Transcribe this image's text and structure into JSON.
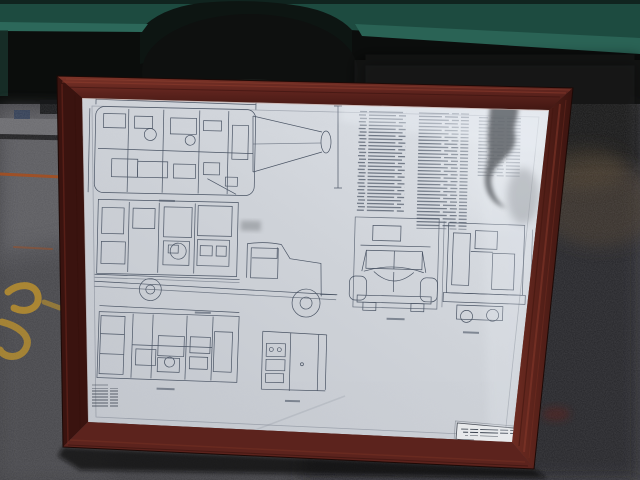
{
  "image_type": "photograph",
  "scene": {
    "subject": "framed technical blueprint leaning against a dark green vehicle on asphalt pavement",
    "frame_material": "dark reddish-brown wood frame with glass",
    "artwork": "multi-view vehicle engineering drawing of a truck with box body",
    "text_legible": false
  },
  "blueprint": {
    "drawings": [
      {
        "id": "plan-view-top",
        "position": "top-left"
      },
      {
        "id": "boom-detail",
        "position": "top-center"
      },
      {
        "id": "parts-list-columns",
        "position": "top-right",
        "columns": 3
      },
      {
        "id": "side-elevation-truck",
        "position": "middle-left"
      },
      {
        "id": "front-view-truck",
        "position": "middle-right"
      },
      {
        "id": "rear-view-truck",
        "position": "far-right"
      },
      {
        "id": "plan-view-bottom",
        "position": "bottom-left"
      },
      {
        "id": "compartment-detail",
        "position": "bottom-center"
      },
      {
        "id": "revision-stamp",
        "position": "bottom-left-corner"
      },
      {
        "id": "title-block",
        "position": "bottom-right",
        "text_lines": 4,
        "text_legible": false
      }
    ]
  },
  "colors": {
    "backdrop_black": "#0b0d0c",
    "vehicle_green": "#1d4b40",
    "vehicle_green_light": "#2c685a",
    "vehicle_green_light2": "#2a6355",
    "vehicle_green_dark": "#0d1512",
    "asphalt": "#3e3e42",
    "asphalt_light": "#5e5e63",
    "asphalt_dark": "#232327",
    "curb_gray": "#6a6a6e",
    "paint_yellow": "#c0942c",
    "paint_orange": "#a84e1c",
    "paint_red_smudge": "#6b1f18",
    "frame_wood": "#5c231d",
    "frame_wood_light": "#8a3a2c",
    "frame_wood_dark": "#3a130f",
    "paper": "#ced2d8",
    "ink": "#4a5464",
    "title_block_bg": "#e7e9eb",
    "glare_white": "#e8edf3",
    "reflection_gray": "#565a5e",
    "debris_brown": "#4a3b2c"
  }
}
